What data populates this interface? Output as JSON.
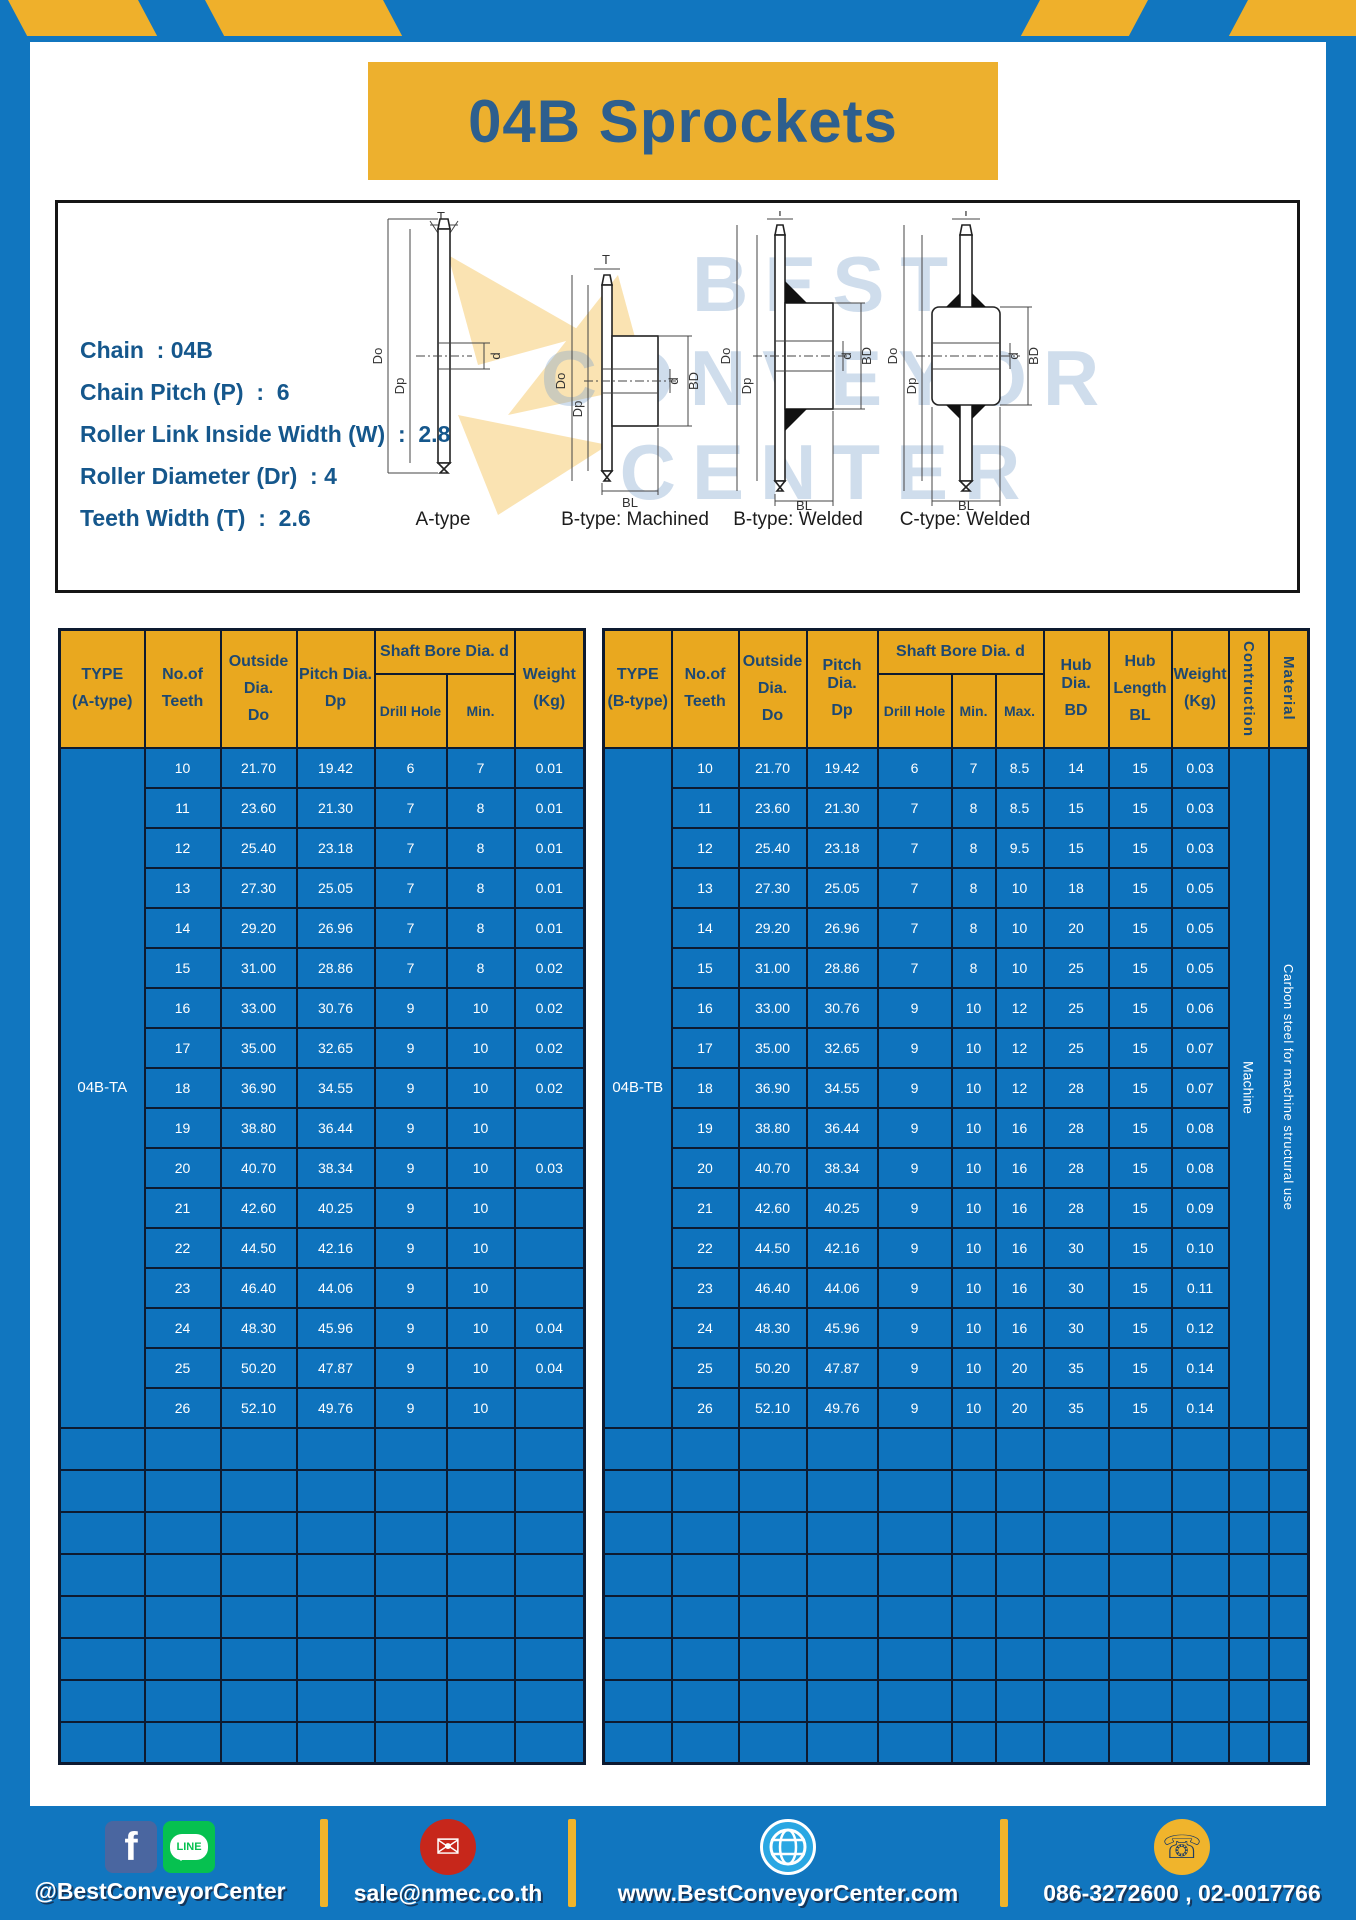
{
  "title": "04B Sprockets",
  "specs": {
    "lines": [
      "Chain  : 04B",
      "Chain Pitch (P)  :  6",
      "Roller Link Inside Width (W)  :  2.8",
      "Roller Diameter (Dr)  : 4",
      "Teeth Width (T)  :  2.6"
    ]
  },
  "drawing": {
    "labels": [
      "A-type",
      "B-type: Machined",
      "B-type: Welded",
      "C-type: Welded"
    ],
    "dims": {
      "t": "T",
      "od": "Do",
      "pd": "Dp",
      "d": "d",
      "bd": "BD",
      "bl": "BL"
    },
    "watermark": [
      "BEST",
      "CONVEYOR",
      "CENTER"
    ]
  },
  "table_a": {
    "headers": {
      "type": [
        "TYPE",
        "(A-type)"
      ],
      "teeth": [
        "No.of",
        "Teeth"
      ],
      "outside": [
        "Outside",
        "Dia.",
        "Do"
      ],
      "pitch": [
        "Pitch Dia.",
        "Dp"
      ],
      "shaft_bore": "Shaft Bore Dia. d",
      "drill": "Drill Hole",
      "min": "Min.",
      "weight": [
        "Weight",
        "(Kg)"
      ]
    },
    "type_value": "04B-TA",
    "rows": [
      [
        "10",
        "21.70",
        "19.42",
        "6",
        "7",
        "0.01"
      ],
      [
        "11",
        "23.60",
        "21.30",
        "7",
        "8",
        "0.01"
      ],
      [
        "12",
        "25.40",
        "23.18",
        "7",
        "8",
        "0.01"
      ],
      [
        "13",
        "27.30",
        "25.05",
        "7",
        "8",
        "0.01"
      ],
      [
        "14",
        "29.20",
        "26.96",
        "7",
        "8",
        "0.01"
      ],
      [
        "15",
        "31.00",
        "28.86",
        "7",
        "8",
        "0.02"
      ],
      [
        "16",
        "33.00",
        "30.76",
        "9",
        "10",
        "0.02"
      ],
      [
        "17",
        "35.00",
        "32.65",
        "9",
        "10",
        "0.02"
      ],
      [
        "18",
        "36.90",
        "34.55",
        "9",
        "10",
        "0.02"
      ],
      [
        "19",
        "38.80",
        "36.44",
        "9",
        "10",
        ""
      ],
      [
        "20",
        "40.70",
        "38.34",
        "9",
        "10",
        "0.03"
      ],
      [
        "21",
        "42.60",
        "40.25",
        "9",
        "10",
        ""
      ],
      [
        "22",
        "44.50",
        "42.16",
        "9",
        "10",
        ""
      ],
      [
        "23",
        "46.40",
        "44.06",
        "9",
        "10",
        ""
      ],
      [
        "24",
        "48.30",
        "45.96",
        "9",
        "10",
        "0.04"
      ],
      [
        "25",
        "50.20",
        "47.87",
        "9",
        "10",
        "0.04"
      ],
      [
        "26",
        "52.10",
        "49.76",
        "9",
        "10",
        ""
      ]
    ],
    "empty_rows": 8
  },
  "table_b": {
    "headers": {
      "type": [
        "TYPE",
        "(B-type)"
      ],
      "teeth": [
        "No.of",
        "Teeth"
      ],
      "outside": [
        "Outside",
        "Dia.",
        "Do"
      ],
      "pitch": [
        "Pitch Dia.",
        "Dp"
      ],
      "shaft_bore": "Shaft Bore Dia. d",
      "drill": "Drill Hole",
      "min": "Min.",
      "max": "Max.",
      "hub_dia": [
        "Hub Dia.",
        "BD"
      ],
      "hub_len": [
        "Hub",
        "Length",
        "BL"
      ],
      "weight": [
        "Weight",
        "(Kg)"
      ],
      "construction": "Contruction",
      "material": "Material"
    },
    "type_value": "04B-TB",
    "construction_value": "Machine",
    "material_value": "Carbon steel for machine structural use",
    "rows": [
      [
        "10",
        "21.70",
        "19.42",
        "6",
        "7",
        "8.5",
        "14",
        "15",
        "0.03"
      ],
      [
        "11",
        "23.60",
        "21.30",
        "7",
        "8",
        "8.5",
        "15",
        "15",
        "0.03"
      ],
      [
        "12",
        "25.40",
        "23.18",
        "7",
        "8",
        "9.5",
        "15",
        "15",
        "0.03"
      ],
      [
        "13",
        "27.30",
        "25.05",
        "7",
        "8",
        "10",
        "18",
        "15",
        "0.05"
      ],
      [
        "14",
        "29.20",
        "26.96",
        "7",
        "8",
        "10",
        "20",
        "15",
        "0.05"
      ],
      [
        "15",
        "31.00",
        "28.86",
        "7",
        "8",
        "10",
        "25",
        "15",
        "0.05"
      ],
      [
        "16",
        "33.00",
        "30.76",
        "9",
        "10",
        "12",
        "25",
        "15",
        "0.06"
      ],
      [
        "17",
        "35.00",
        "32.65",
        "9",
        "10",
        "12",
        "25",
        "15",
        "0.07"
      ],
      [
        "18",
        "36.90",
        "34.55",
        "9",
        "10",
        "12",
        "28",
        "15",
        "0.07"
      ],
      [
        "19",
        "38.80",
        "36.44",
        "9",
        "10",
        "16",
        "28",
        "15",
        "0.08"
      ],
      [
        "20",
        "40.70",
        "38.34",
        "9",
        "10",
        "16",
        "28",
        "15",
        "0.08"
      ],
      [
        "21",
        "42.60",
        "40.25",
        "9",
        "10",
        "16",
        "28",
        "15",
        "0.09"
      ],
      [
        "22",
        "44.50",
        "42.16",
        "9",
        "10",
        "16",
        "30",
        "15",
        "0.10"
      ],
      [
        "23",
        "46.40",
        "44.06",
        "9",
        "10",
        "16",
        "30",
        "15",
        "0.11"
      ],
      [
        "24",
        "48.30",
        "45.96",
        "9",
        "10",
        "16",
        "30",
        "15",
        "0.12"
      ],
      [
        "25",
        "50.20",
        "47.87",
        "9",
        "10",
        "20",
        "35",
        "15",
        "0.14"
      ],
      [
        "26",
        "52.10",
        "49.76",
        "9",
        "10",
        "20",
        "35",
        "15",
        "0.14"
      ]
    ],
    "empty_rows": 8
  },
  "footer": {
    "line_badge": "LINE",
    "fb_glyph": "f",
    "items": [
      {
        "label": "@BestConveyorCenter"
      },
      {
        "label": "sale@nmec.co.th"
      },
      {
        "label": "www.BestConveyorCenter.com"
      },
      {
        "label": "086-3272600 , 02-0017766"
      }
    ]
  },
  "colors": {
    "frame_blue": "#1176bf",
    "cell_blue": "#0e73bd",
    "header_yellow": "#e9a81f",
    "title_yellow": "#edb02e",
    "border_navy": "#0d1a30"
  }
}
